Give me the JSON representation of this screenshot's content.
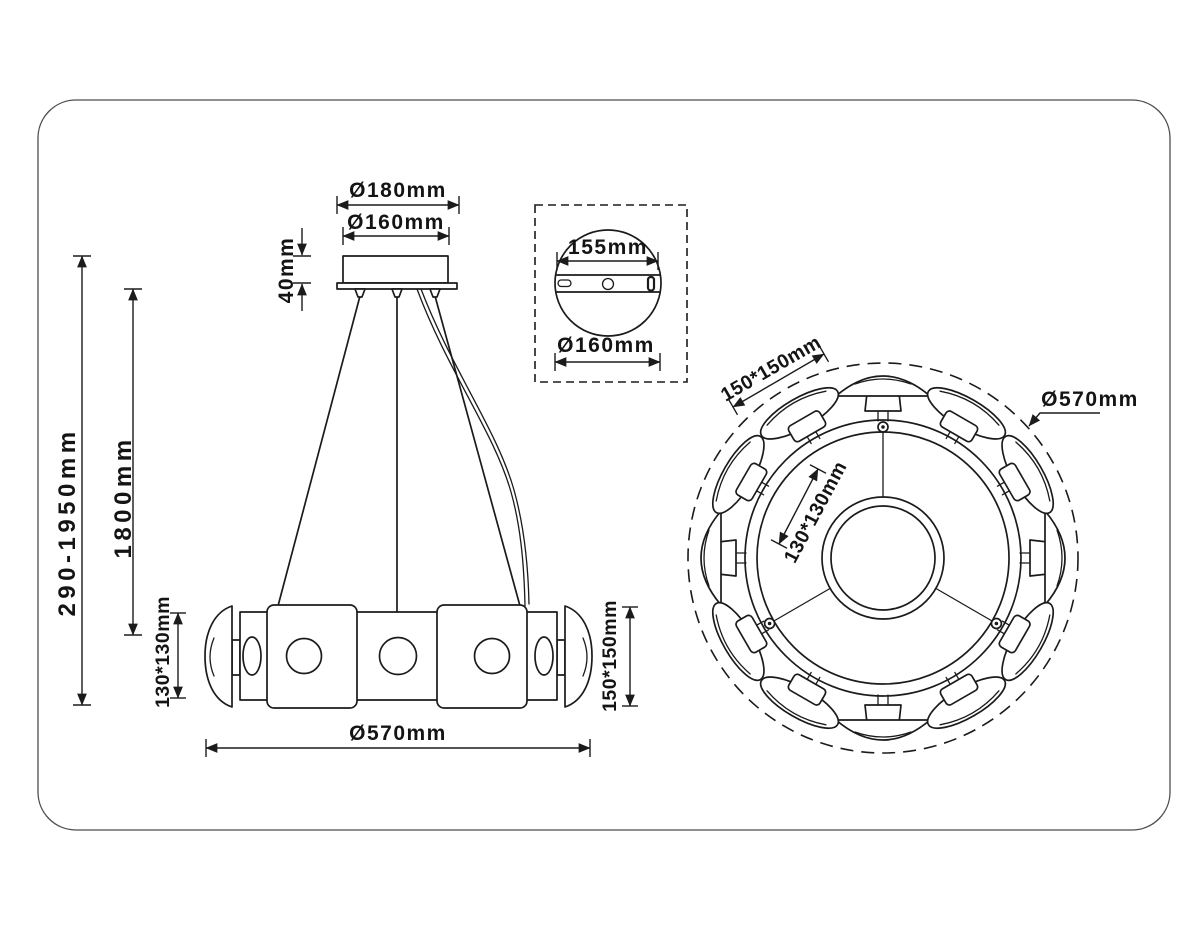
{
  "drawing": {
    "front": {
      "canopy_outer_diameter": "Ø180mm",
      "canopy_inner_diameter": "Ø160mm",
      "canopy_height": "40mm",
      "overall_height_range": "290-1950mm",
      "suspension_length": "1800mm",
      "side_shade_size": "130*130mm",
      "body_height": "150*150mm",
      "body_diameter": "Ø570mm"
    },
    "canopy_inset": {
      "bracket_width": "155mm",
      "plate_diameter": "Ø160mm"
    },
    "top": {
      "shade_size": "150*150mm",
      "inner_shade_size": "130*130mm",
      "outer_diameter": "Ø570mm"
    },
    "colors": {
      "line": "#1b1b1b",
      "frame": "#4d4d4d",
      "background": "#ffffff"
    }
  }
}
